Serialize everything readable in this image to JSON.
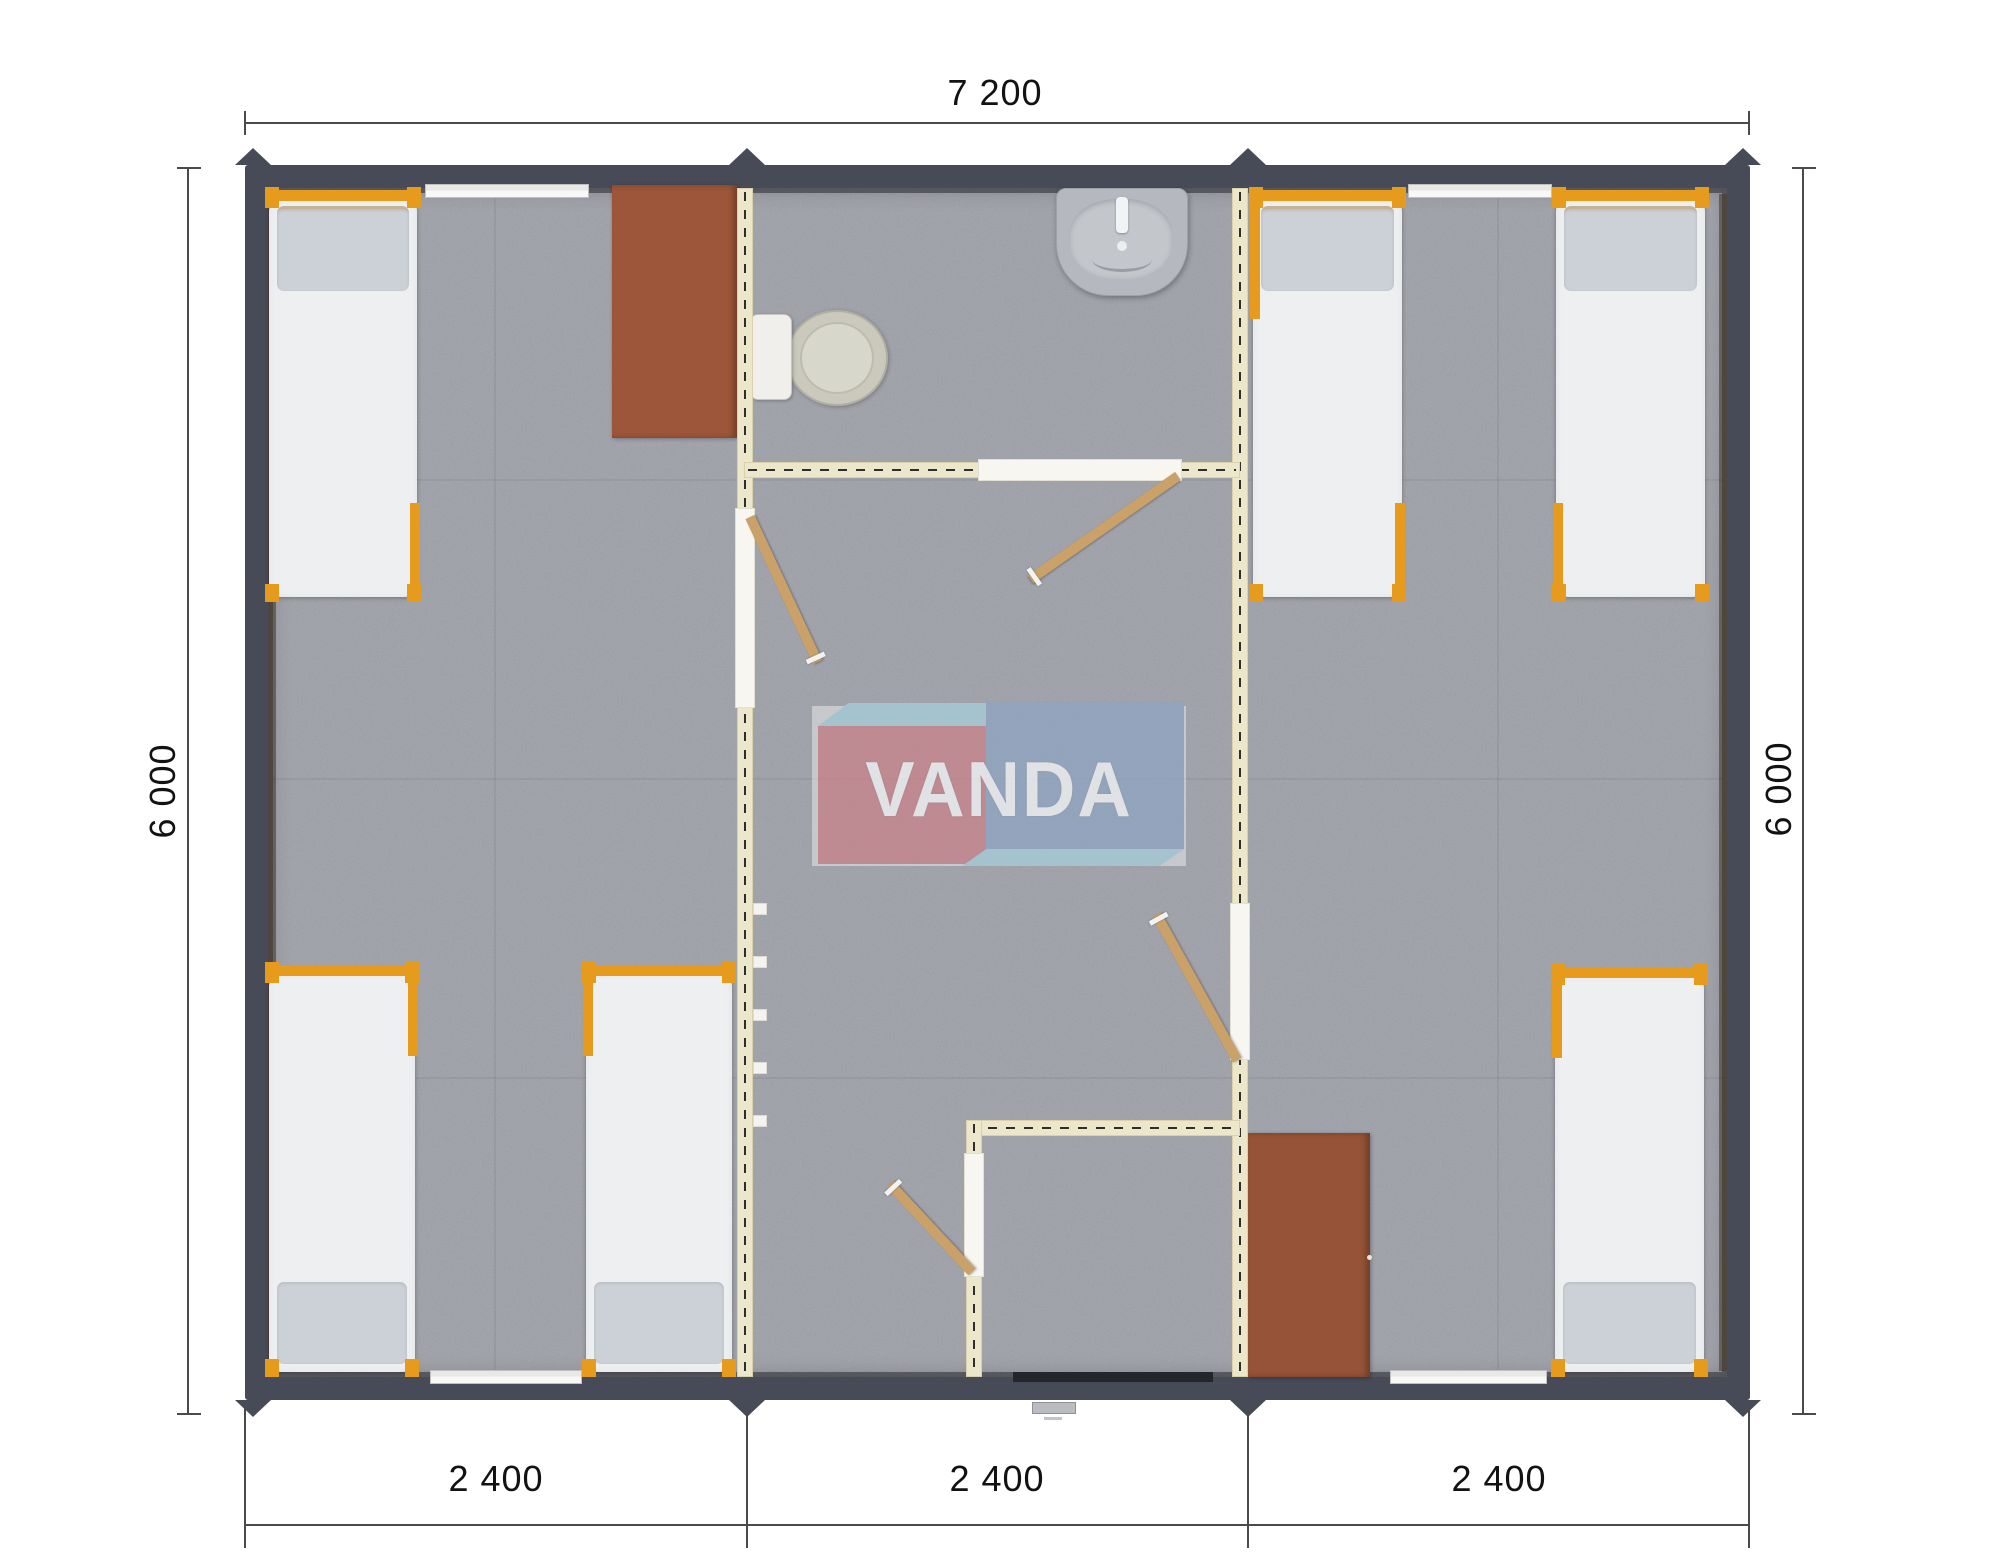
{
  "dimensions": {
    "top": "7 200",
    "left": "6 000",
    "right": "6 000",
    "bottom": [
      "2 400",
      "2 400",
      "2 400"
    ]
  },
  "logo": {
    "text": "VANDA"
  },
  "plan_objects": {
    "beds": 6,
    "desks": 2,
    "toilet": 1,
    "washbasin": 1,
    "shower_room": 1,
    "interior_doors": 4,
    "windows": 4,
    "entrance": 1,
    "modules": 3
  },
  "colors": {
    "wall_dark": "#474b58",
    "partition_cream": "#ece6cb",
    "partition_edge": "#d8d1ab",
    "floor": "#a9abb2",
    "bed_frame_orange": "#e79b1d",
    "mattress": "#edeff1",
    "pillow": "#ccd1d7",
    "desk_brown": "#9d5639",
    "door_tan": "#c9a169",
    "window_white": "#f8f8f6",
    "dim_line": "#4a4a4a",
    "dim_text": "#121212",
    "logo_pink": "#c6858d",
    "logo_blue": "#90a5c0",
    "logo_light_blue": "#a6cbd6"
  }
}
